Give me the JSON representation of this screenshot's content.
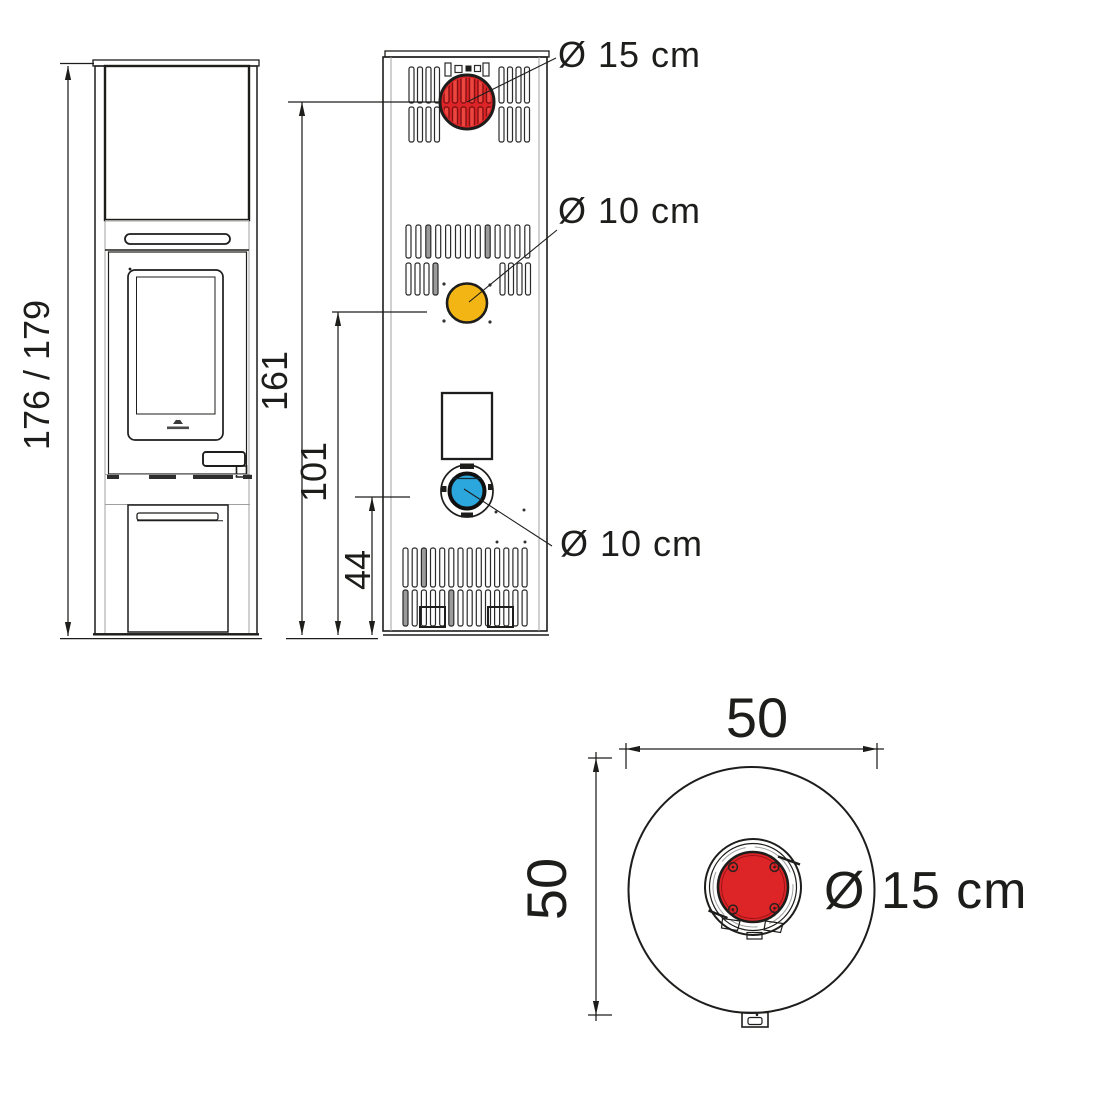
{
  "colors": {
    "line": "#1d1d1b",
    "flue_red": "#dd2427",
    "secondary_yellow": "#f2b514",
    "intake_blue": "#2ba7dd"
  },
  "front_view": {
    "dim_overall_height": "176 / 179"
  },
  "rear_view": {
    "flue_outlet_label": "Ø 15 cm",
    "flue_outlet_dim_height": "161",
    "secondary_outlet_label": "Ø 10 cm",
    "secondary_outlet_dim_height": "101",
    "air_intake_label": "Ø 10 cm",
    "air_intake_dim_height": "44"
  },
  "top_view": {
    "dim_width": "50",
    "dim_depth": "50",
    "flue_diameter_label": "Ø 15 cm"
  }
}
